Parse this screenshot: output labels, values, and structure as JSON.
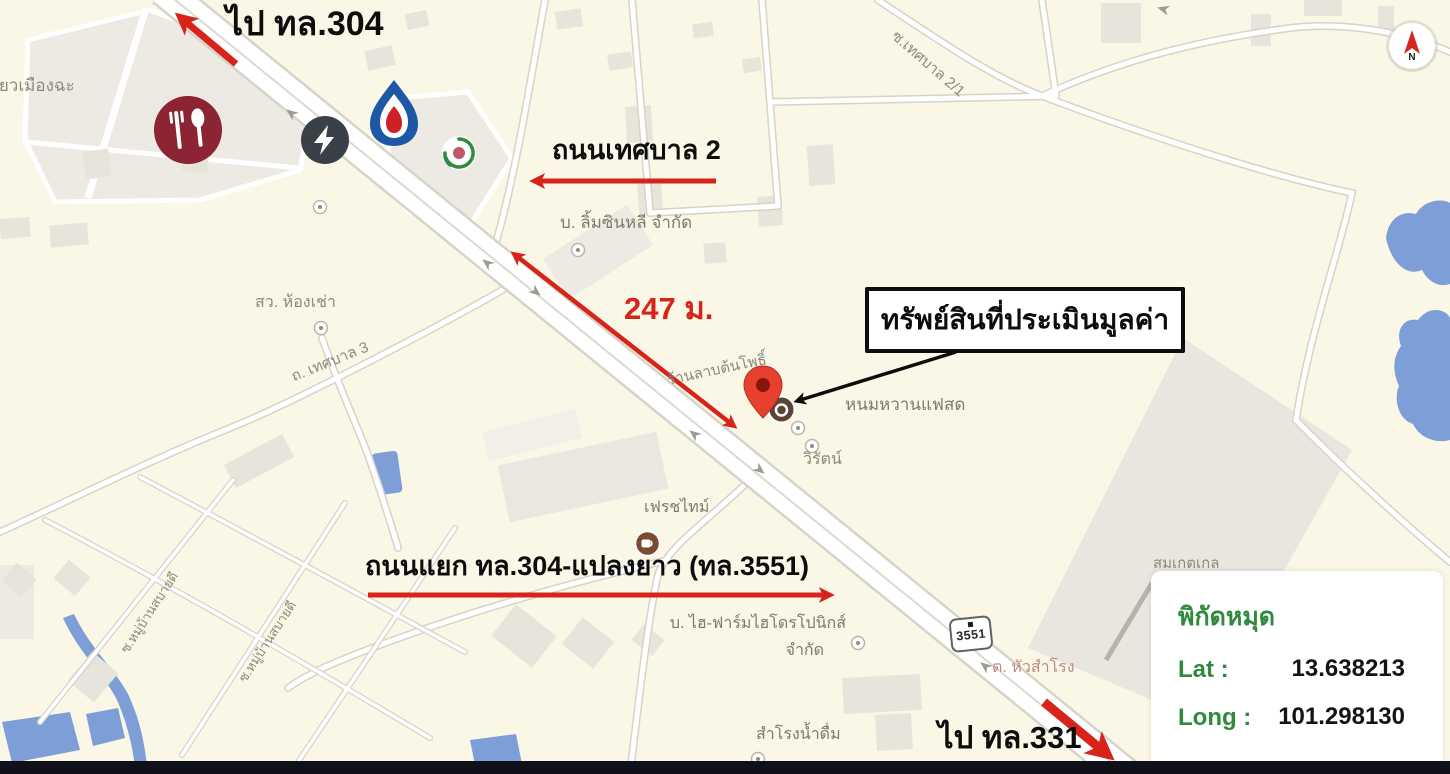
{
  "annotations": {
    "to_hw304": "ไป ทล.304",
    "road_thetsaban2": "ถนนเทศบาล 2",
    "distance": "247 ม.",
    "property_box": "ทรัพย์สินที่ประเมินมูลค่า",
    "junction_road": "ถนนแยก ทล.304-แปลงยาว (ทล.3551)",
    "to_hw331": "ไป ทล.331"
  },
  "coordinate_card": {
    "title": "พิกัดหมุด",
    "lat_label": "Lat :",
    "lat_value": "13.638213",
    "long_label": "Long :",
    "long_value": "101.298130"
  },
  "map_labels": {
    "noodle_shop": "เตี๋ยวเมืองฉะ",
    "rental_rooms": "สว. ห้องเช่า",
    "road_thetsaban3": "ถ. เทศบาล 3",
    "soi_thetsaban21": "ซ.เทศบาล 2/1",
    "company_limsinlee": "บ. ลิ้มซินหลี จำกัด",
    "lab_tonpho": "ร้านลาบต้นโพธิ์",
    "dessert_shop": "หนมหวานแฟสด",
    "wirat": "วิรัตน์",
    "freshtime": "เฟรชไทม์",
    "hifarm_line1": "บ. ไฮ-ฟาร์มไฮโดรโปนิกส์",
    "hifarm_line2": "จำกัด",
    "samrong_water": "สำโรงน้ำดื่ม",
    "tambon_huasamrong": "ต. หัวสำโรง",
    "somket": "สมเกตเกล",
    "noppaket": "บ. นพเกตกรุ๊ป",
    "soi_sabaidee_1": "ซ.หมู่บ้านสบายดี",
    "soi_sabaidee_2": "ซ.หมู่บ้านสบายดี"
  },
  "route_shield": {
    "number": "3551"
  },
  "compass": {
    "north": "N"
  },
  "colors": {
    "annotation_red": "#D8231A",
    "coordinate_green": "#2F8A3D",
    "water_blue": "#7D9ED6",
    "pin_red": "#E8402F",
    "map_background": "#FAF7E6"
  }
}
